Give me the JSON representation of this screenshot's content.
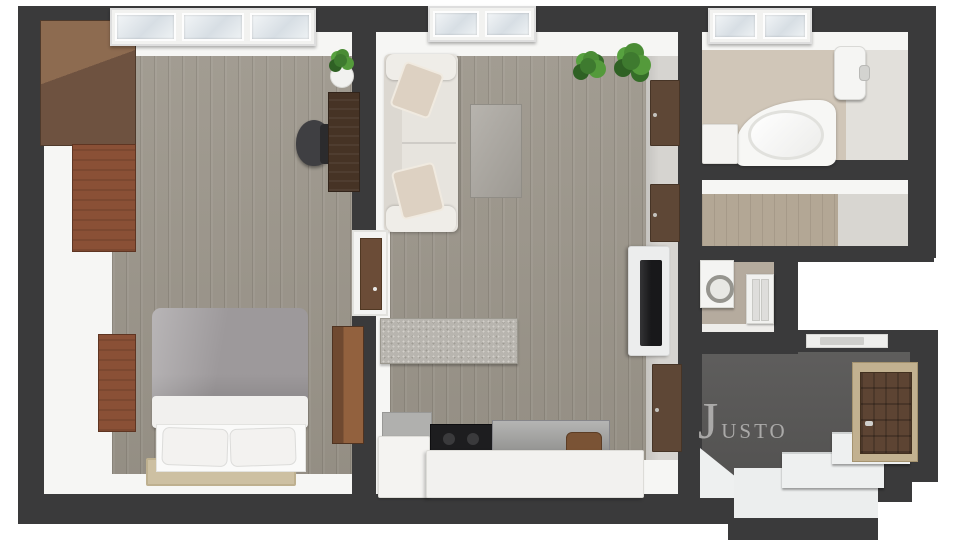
{
  "meta": {
    "kind": "3d-top-view-floor-plan-render",
    "background": "#ffffff"
  },
  "watermark": {
    "text": "Justo",
    "color": "#b2b1b0"
  },
  "palette": {
    "wall": "#3a3a3b",
    "wall_inner_face": "#f6f6f4",
    "wood_floor": "#9c968b",
    "hall_wood_floor": "#b3a795",
    "bathroom_tile": "#d0c6b8",
    "wc_tile": "#b5ab9e",
    "entry_floor": "#585756",
    "furniture_walnut": "#6e5240",
    "furniture_cherry": "#8a5036",
    "sofa": "#e7e4de",
    "tv": "#18181a",
    "plant_green": "#4a8c35"
  },
  "rooms": [
    {
      "id": "bedroom",
      "floor": "wood"
    },
    {
      "id": "living-room-with-kitchen",
      "floor": "wood"
    },
    {
      "id": "bathroom",
      "floor": "beige-tile"
    },
    {
      "id": "hallway-closet",
      "floor": "light-wood"
    },
    {
      "id": "wc-laundry",
      "floor": "beige-tile"
    },
    {
      "id": "entrance-hall",
      "floor": "dark-gray"
    }
  ],
  "objects": [
    "wardrobe",
    "wardrobe-cherry",
    "nightstand",
    "side-cabinet",
    "double-bed",
    "pillows",
    "rug",
    "desk",
    "office-chair",
    "potted-plant-small",
    "sofa",
    "sofa-cushions",
    "coffee-table",
    "sideboard",
    "kitchen-cabinet",
    "cooktop",
    "kitchen-counter",
    "bar-chair",
    "kitchen-island",
    "tv-console",
    "tv",
    "wall-door-panels",
    "corner-bathtub",
    "water-heater",
    "bath-cabinet",
    "bathroom-window",
    "washing-machine",
    "wc-door",
    "front-door",
    "entry-steps",
    "entry-landing",
    "bedroom-window",
    "living-room-window",
    "plants"
  ]
}
